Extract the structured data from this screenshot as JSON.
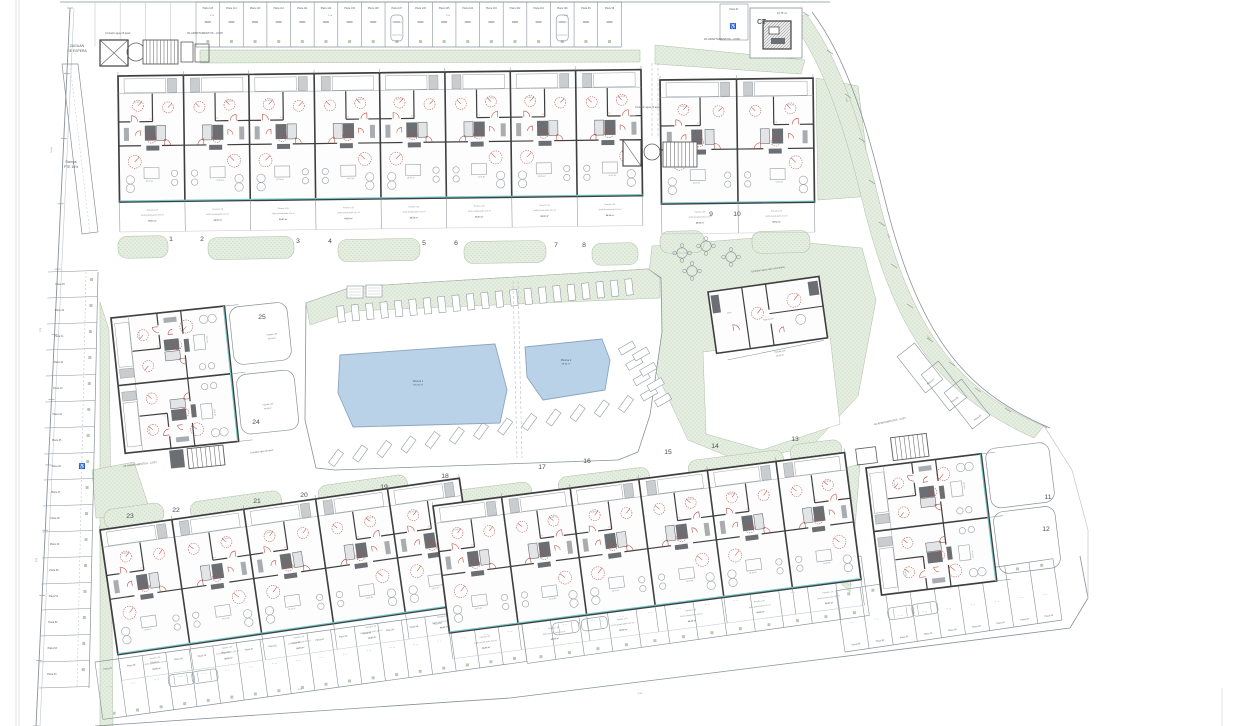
{
  "title_note": "residential development site plan",
  "colors": {
    "green": "#e5eee0",
    "greenDot": "#b7cbb0",
    "pool": "#b9d2e8",
    "poolEdge": "#8ca6bf",
    "poolText": "#3f5a75",
    "wall": "#3f3f3f",
    "line": "#8a9298",
    "faint": "#c3c7ca",
    "red": "#b3483f",
    "teal": "#72c7c9",
    "text": "#5a5f63",
    "num": "#4a4f52",
    "dark": "#5c5c5c"
  },
  "labels": [
    {
      "t": "ZAGUAN",
      "x": 77,
      "y": 47,
      "s": 3.4
    },
    {
      "t": "DE ESPERA",
      "x": 77,
      "y": 52,
      "s": 3.4
    },
    {
      "t": "Rampa",
      "x": 71,
      "y": 163,
      "s": 3.4
    },
    {
      "t": "PTE 16%",
      "x": 71,
      "y": 168,
      "s": 3.4
    },
    {
      "t": "Contador agua 25 apart.",
      "x": 118,
      "y": 34,
      "s": 2.4
    },
    {
      "t": "26-APARTAMENTOS - COPI",
      "x": 205,
      "y": 34,
      "s": 2.8
    },
    {
      "t": "Contador agua 20 apart.",
      "x": 648,
      "y": 108,
      "s": 2.4
    },
    {
      "t": "20-APARTAMENTOS - COPI",
      "x": 722,
      "y": 40,
      "s": 2.8
    },
    {
      "t": "CT",
      "x": 757,
      "y": 24,
      "s": 7,
      "b": 1,
      "anchor": "start"
    },
    {
      "t": "22.75 m²",
      "x": 782,
      "y": 14,
      "s": 2.6
    },
    {
      "t": "26-APARTAMENTOS - COPI",
      "x": 140,
      "y": 465,
      "s": 2.6,
      "a": -7
    },
    {
      "t": "Contador agua 26 apart.",
      "x": 262,
      "y": 452,
      "s": 2.2,
      "a": -7
    },
    {
      "t": "Contador agua sala comunitaria",
      "x": 768,
      "y": 270,
      "s": 2.4,
      "a": -8
    },
    {
      "t": "40-APARTAMENTOS - COPI",
      "x": 890,
      "y": 422,
      "s": 2.5,
      "a": -12
    },
    {
      "t": "Parcela 1.29",
      "x": 272,
      "y": 335,
      "s": 1.9,
      "a": -6
    },
    {
      "t": "98.50 m²",
      "x": 272,
      "y": 339,
      "s": 1.9,
      "a": -6
    },
    {
      "t": "Parcela 1.29",
      "x": 268,
      "y": 405,
      "s": 1.9,
      "a": -6
    },
    {
      "t": "98.50 m²",
      "x": 268,
      "y": 409,
      "s": 1.9,
      "a": -6
    },
    {
      "t": "Parcela 1.29",
      "x": 780,
      "y": 352,
      "s": 1.9,
      "a": -8
    },
    {
      "t": "46.20 m²",
      "x": 780,
      "y": 356,
      "s": 1.9,
      "a": -8
    }
  ],
  "dims": [
    {
      "t": "12.46",
      "x": 52,
      "y": 150,
      "a": -86
    },
    {
      "t": "7.05",
      "x": 41,
      "y": 330,
      "a": -86
    },
    {
      "t": "5.00",
      "x": 37,
      "y": 560,
      "a": -86
    },
    {
      "t": "2.50",
      "x": 212,
      "y": 16
    },
    {
      "t": "2.50",
      "x": 330,
      "y": 16
    },
    {
      "t": "2.50",
      "x": 448,
      "y": 16
    },
    {
      "t": "2.50",
      "x": 566,
      "y": 16
    },
    {
      "t": "2.50",
      "x": 846,
      "y": 100,
      "a": 72
    },
    {
      "t": "2.50",
      "x": 888,
      "y": 236,
      "a": 78
    },
    {
      "t": "2.50",
      "x": 928,
      "y": 338,
      "a": 48
    },
    {
      "t": "4.50",
      "x": 640,
      "y": 694,
      "a": -8
    },
    {
      "t": "4.50",
      "x": 300,
      "y": 690,
      "a": -8
    }
  ],
  "blocks": [
    {
      "n": "1",
      "x": 171,
      "y": 241
    },
    {
      "n": "2",
      "x": 202,
      "y": 241
    },
    {
      "n": "3",
      "x": 298,
      "y": 243
    },
    {
      "n": "4",
      "x": 330,
      "y": 243
    },
    {
      "n": "5",
      "x": 424,
      "y": 245
    },
    {
      "n": "6",
      "x": 456,
      "y": 245
    },
    {
      "n": "7",
      "x": 556,
      "y": 247
    },
    {
      "n": "8",
      "x": 584,
      "y": 247
    },
    {
      "n": "9",
      "x": 711,
      "y": 216
    },
    {
      "n": "10",
      "x": 737,
      "y": 216
    },
    {
      "n": "11",
      "x": 1048,
      "y": 499
    },
    {
      "n": "12",
      "x": 1046,
      "y": 531
    },
    {
      "n": "13",
      "x": 795,
      "y": 441
    },
    {
      "n": "14",
      "x": 715,
      "y": 448
    },
    {
      "n": "15",
      "x": 668,
      "y": 454
    },
    {
      "n": "16",
      "x": 587,
      "y": 463
    },
    {
      "n": "17",
      "x": 542,
      "y": 469
    },
    {
      "n": "18",
      "x": 445,
      "y": 478
    },
    {
      "n": "19",
      "x": 384,
      "y": 489
    },
    {
      "n": "20",
      "x": 304,
      "y": 497
    },
    {
      "n": "21",
      "x": 257,
      "y": 503
    },
    {
      "n": "22",
      "x": 176,
      "y": 512
    },
    {
      "n": "23",
      "x": 130,
      "y": 518
    },
    {
      "n": "24",
      "x": 256,
      "y": 424
    },
    {
      "n": "25",
      "x": 262,
      "y": 319
    }
  ],
  "buildings": [
    {
      "id": "building-blocks-1-8",
      "x": 118,
      "y": 76,
      "a": -0.7,
      "w": 523,
      "h": 126,
      "m": 8,
      "face": "down",
      "tlen": 30
    },
    {
      "id": "building-blocks-9-10",
      "x": 660,
      "y": 80,
      "a": -0.7,
      "w": 153,
      "h": 124,
      "m": 2,
      "face": "down",
      "tlen": 30
    },
    {
      "id": "building-blocks-19-23",
      "x": 100,
      "y": 530,
      "a": -8.2,
      "w": 363,
      "h": 126,
      "m": 5,
      "face": "down",
      "tlen": 26
    },
    {
      "id": "building-blocks-13-18",
      "x": 433,
      "y": 506,
      "a": -7.4,
      "w": 415,
      "h": 128,
      "m": 6,
      "face": "down",
      "tlen": 26
    },
    {
      "id": "building-blocks-24-25",
      "x": 111,
      "y": 318,
      "a": -6,
      "w": 114,
      "h": 136,
      "m": 2,
      "face": "right"
    },
    {
      "id": "building-blocks-11-12",
      "x": 866,
      "y": 468,
      "a": -7,
      "w": 116,
      "h": 128,
      "m": 2,
      "face": "right"
    }
  ],
  "garden_texts": [
    "Parcela 1.29",
    "Jardín privado jardín 10.5 m²",
    "98.50 m²"
  ],
  "unit_texts": {
    "bed": "10.35 m²",
    "living": "18.70 m²",
    "dim": "2.77"
  },
  "pools": [
    {
      "name": "Piscina 1",
      "area": "436.30 m²",
      "lx": 418,
      "ly": 382,
      "pts": [
        [
          340,
          355
        ],
        [
          495,
          344
        ],
        [
          507,
          390
        ],
        [
          500,
          423
        ],
        [
          353,
          427
        ],
        [
          338,
          393
        ]
      ]
    },
    {
      "name": "Piscina 2",
      "area": "98.90 m²",
      "lx": 566,
      "ly": 361,
      "pts": [
        [
          525,
          347
        ],
        [
          602,
          339
        ],
        [
          610,
          360
        ],
        [
          605,
          390
        ],
        [
          543,
          400
        ],
        [
          527,
          377
        ]
      ]
    }
  ],
  "deck": {
    "outline": [
      [
        306,
        303
      ],
      [
        352,
        287
      ],
      [
        648,
        269
      ],
      [
        661,
        278
      ],
      [
        662,
        332
      ],
      [
        650,
        415
      ],
      [
        638,
        452
      ],
      [
        618,
        460
      ],
      [
        335,
        470
      ],
      [
        316,
        468
      ],
      [
        305,
        420
      ]
    ],
    "band": [
      [
        306,
        303
      ],
      [
        352,
        287
      ],
      [
        648,
        269
      ],
      [
        660,
        278
      ],
      [
        660,
        298
      ],
      [
        352,
        311
      ],
      [
        310,
        325
      ]
    ],
    "boxes": [
      [
        347,
        286
      ],
      [
        366,
        285
      ]
    ],
    "loungersTop": {
      "from": [
        341,
        314
      ],
      "to": [
        629,
        287
      ],
      "n": 21,
      "a": -6
    },
    "loungersBottom": {
      "from": [
        336,
        458
      ],
      "to": [
        626,
        404
      ],
      "n": 13,
      "a": 36
    },
    "loungersRight": {
      "from": [
        627,
        348
      ],
      "to": [
        649,
        394
      ],
      "n": 4,
      "a": 60
    },
    "divider": [
      [
        513,
        281
      ],
      [
        517,
        458
      ]
    ]
  },
  "parking": {
    "top": {
      "x0": 196,
      "y": 2,
      "pitch": 23.63,
      "n": 18,
      "depth": 45,
      "cars": [
        8,
        15
      ],
      "labels": [
        "Plaza 115",
        "Plaza 114",
        "Plaza 113",
        "Plaza 112",
        "Plaza 111",
        "Plaza 110",
        "Plaza 109",
        "Plaza 108",
        "Plaza 107",
        "Plaza 106",
        "Plaza 105",
        "Plaza 104",
        "Plaza 103",
        "Plaza 102",
        "Plaza 101",
        "Plaza 100",
        "Plaza 99",
        "Plaza 98"
      ]
    },
    "top_extra": {
      "x0": 95,
      "y": 2,
      "pitch": 25.2,
      "n": 4,
      "depth": 44
    },
    "left": {
      "y0": 272,
      "pitch": 26,
      "n": 16,
      "x": 48,
      "w": 50,
      "wheelAfter": 7,
      "labels": [
        "Plaza 39",
        "Plaza 40",
        "Plaza 41",
        "Plaza 42",
        "Plaza 43",
        "Plaza 44",
        "Plaza 45",
        "Plaza 46",
        "Plaza 47",
        "Plaza 48",
        "Plaza 49",
        "Plaza 50",
        "Plaza 51",
        "Plaza 52",
        "Plaza 53",
        "Plaza 54"
      ]
    },
    "band1": {
      "from": [
        95,
        662
      ],
      "to": [
        519,
        604
      ],
      "depth": 58,
      "n": 18,
      "cars": [
        3,
        4
      ],
      "labels": [
        "Plaza 55",
        "Plaza 56",
        "Plaza 57",
        "Plaza 58",
        "Plaza 59",
        "Plaza 60",
        "Plaza 61",
        "Plaza 62",
        "Plaza 63",
        "Plaza 64",
        "Plaza 65",
        "Plaza 66",
        "Plaza 67",
        "Plaza 68",
        "Plaza 69",
        "Plaza 70",
        "Plaza 71",
        "Plaza 72"
      ]
    },
    "band2": {
      "from": [
        519,
        604
      ],
      "to": [
        861,
        556
      ],
      "depth": 60,
      "n": 12,
      "cars": [
        1,
        2
      ],
      "labels": [
        "Plaza 73",
        "Plaza 74",
        "Plaza 75",
        "Plaza 76",
        "Plaza 77",
        "Plaza 78",
        "Plaza 79",
        "Plaza 80",
        "Plaza 81",
        "Plaza 82",
        "Plaza 83",
        "Plaza 84"
      ]
    },
    "band3": {
      "from": [
        845,
        652
      ],
      "to": [
        1062,
        620
      ],
      "depth": -62,
      "n": 9,
      "cars": [
        2,
        3
      ],
      "labels": [
        "Plaza 88",
        "Plaza 89",
        "Plaza 90",
        "Plaza 91",
        "Plaza 92",
        "Plaza 93",
        "Plaza 94",
        "Plaza 95",
        "Plaza 96"
      ]
    },
    "curve": {
      "a": -38,
      "stalls": [
        [
          920,
          368
        ],
        [
          944,
          386
        ],
        [
          967,
          404
        ]
      ],
      "labels": [
        "Plaza 87",
        "Plaza 86",
        "Plaza 85"
      ]
    },
    "ct_stall_label": "Plaza 97"
  },
  "greens": [
    [
      [
        200,
        50
      ],
      [
        640,
        50
      ],
      [
        640,
        62
      ],
      [
        200,
        63
      ]
    ],
    [
      [
        655,
        45
      ],
      [
        805,
        60
      ],
      [
        801,
        74
      ],
      [
        655,
        64
      ]
    ],
    [
      [
        816,
        78
      ],
      [
        858,
        86
      ],
      [
        872,
        196
      ],
      [
        818,
        200
      ]
    ],
    [
      [
        100,
        302
      ],
      [
        109,
        330
      ],
      [
        113,
        726
      ],
      [
        100,
        726
      ]
    ],
    [
      [
        92,
        470
      ],
      [
        134,
        462
      ],
      [
        152,
        516
      ],
      [
        96,
        518
      ]
    ],
    [
      [
        468,
        500
      ],
      [
        484,
        494
      ],
      [
        502,
        620
      ],
      [
        488,
        628
      ]
    ],
    [
      [
        822,
        474
      ],
      [
        860,
        464
      ],
      [
        850,
        592
      ],
      [
        816,
        560
      ]
    ]
  ],
  "hill": [
    [
      652,
      246
    ],
    [
      755,
      238
    ],
    [
      862,
      248
    ],
    [
      876,
      300
    ],
    [
      858,
      396
    ],
    [
      812,
      446
    ],
    [
      742,
      462
    ],
    [
      688,
      440
    ],
    [
      656,
      372
    ],
    [
      646,
      300
    ]
  ],
  "hill_hole": [
    [
      703,
      352
    ],
    [
      830,
      336
    ],
    [
      840,
      424
    ],
    [
      762,
      450
    ],
    [
      706,
      434
    ]
  ],
  "ne_band": "M806,14 C842,62 862,130 878,196 C894,262 916,320 952,362 C976,390 1006,410 1044,426 L1034,438 C994,420 962,398 936,368 C900,326 878,266 862,200 C846,134 826,68 792,22 Z",
  "ne_outer": "M812,12 C848,60 868,130 884,196 C900,262 922,322 958,364 C982,392 1012,412 1050,428",
  "ne_ticks": [
    [
      806,
      14
    ],
    [
      830,
      52
    ],
    [
      848,
      96
    ],
    [
      862,
      140
    ],
    [
      872,
      182
    ],
    [
      882,
      224
    ],
    [
      894,
      266
    ],
    [
      910,
      306
    ],
    [
      930,
      340
    ],
    [
      952,
      364
    ],
    [
      978,
      390
    ],
    [
      1008,
      410
    ],
    [
      1044,
      426
    ]
  ],
  "mounds": [
    [
      118,
      236,
      50,
      22,
      -1
    ],
    [
      208,
      237,
      86,
      22,
      -1
    ],
    [
      338,
      239,
      82,
      22,
      -1
    ],
    [
      464,
      241,
      82,
      22,
      -1
    ],
    [
      592,
      243,
      46,
      22,
      -1
    ],
    [
      660,
      231,
      44,
      22,
      -1
    ],
    [
      752,
      231,
      58,
      22,
      -1
    ],
    [
      104,
      506,
      60,
      20,
      -8
    ],
    [
      190,
      496,
      92,
      20,
      -8
    ],
    [
      318,
      480,
      90,
      20,
      -8
    ],
    [
      452,
      486,
      80,
      20,
      -7
    ],
    [
      558,
      472,
      92,
      20,
      -7
    ],
    [
      688,
      455,
      96,
      20,
      -7
    ],
    [
      790,
      442,
      52,
      18,
      -7
    ]
  ],
  "tables": [
    [
      682,
      253
    ],
    [
      706,
      246
    ],
    [
      731,
      257
    ],
    [
      692,
      271
    ]
  ],
  "entry": {
    "lift": [
      100,
      40,
      28,
      26
    ],
    "circle": [
      136,
      52,
      9
    ],
    "stairs": [
      143,
      40,
      35,
      24
    ],
    "sideRects": [
      [
        181,
        42,
        12,
        20
      ],
      [
        195,
        44,
        14,
        18
      ]
    ],
    "ramp": [
      [
        62,
        64
      ],
      [
        78,
        64
      ],
      [
        98,
        232
      ],
      [
        82,
        234
      ]
    ]
  },
  "cluster910": {
    "lift": [
      623,
      140,
      18,
      26
    ],
    "circle": [
      652,
      152,
      8
    ],
    "stairs": [
      663,
      142,
      34,
      25
    ]
  },
  "ct": {
    "stall": [
      720,
      4,
      28,
      36
    ],
    "outer": [
      750,
      8,
      52,
      50
    ],
    "inner": [
      763,
      21,
      28,
      28
    ],
    "wheel": [
      733,
      28
    ]
  },
  "community": {
    "x": 708,
    "y": 292,
    "a": -8,
    "w": 112,
    "h": 62,
    "room1": "Sala común",
    "room2": "Aseo"
  },
  "boundary": {
    "west": [
      [
        70,
        8
      ],
      [
        36,
        726
      ]
    ],
    "west2": [
      [
        74,
        8
      ],
      [
        40,
        726
      ]
    ],
    "top": [
      [
        60,
        2
      ],
      [
        830,
        2
      ]
    ],
    "bottom": [
      [
        95,
        726
      ],
      [
        510,
        698
      ],
      [
        800,
        662
      ],
      [
        1070,
        628
      ],
      [
        1088,
        598
      ],
      [
        1080,
        556
      ]
    ],
    "east": [
      [
        1044,
        426
      ],
      [
        1072,
        470
      ],
      [
        1088,
        530
      ],
      [
        1088,
        598
      ]
    ]
  },
  "paper_edges": [
    [
      [
        16,
        0
      ],
      [
        16,
        726
      ]
    ],
    [
      [
        19,
        0
      ],
      [
        19,
        726
      ]
    ],
    [
      [
        1222,
        688
      ],
      [
        1222,
        726
      ]
    ]
  ],
  "dashed_paths": [
    [
      [
        652,
        63
      ],
      [
        652,
        138
      ]
    ],
    [
      [
        658,
        63
      ],
      [
        658,
        138
      ]
    ],
    [
      [
        476,
        502
      ],
      [
        494,
        628
      ]
    ],
    [
      [
        486,
        500
      ],
      [
        504,
        626
      ]
    ]
  ]
}
